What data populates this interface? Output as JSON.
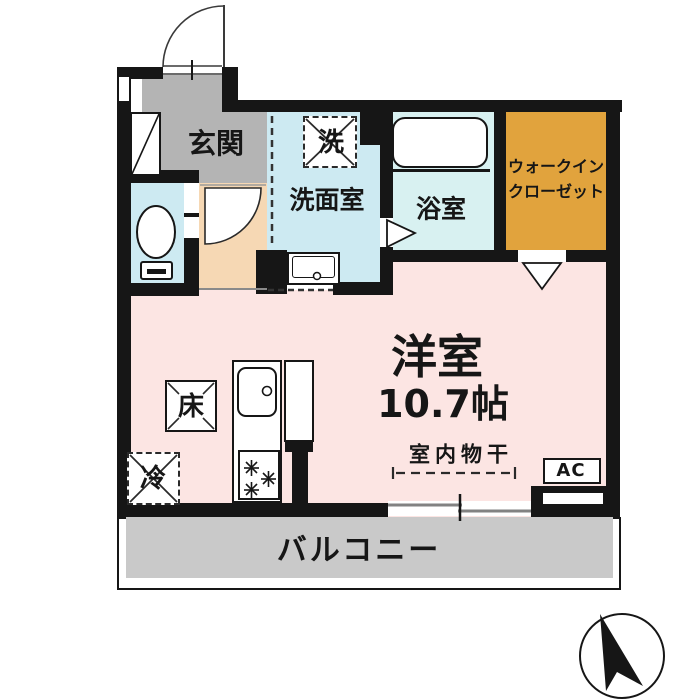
{
  "plan": {
    "rooms": {
      "genkan": "玄関",
      "washroom": "洗面室",
      "washer": "洗",
      "bathroom": "浴室",
      "wic_line1": "ウォークイン",
      "wic_line2": "クローゼット",
      "main_room_name": "洋室",
      "main_room_size": "10.7帖",
      "balcony": "バルコニー"
    },
    "fixtures": {
      "floor_storage": "床",
      "fridge": "冷",
      "ac": "AC",
      "indoor_drying": "室内物干"
    },
    "colors": {
      "wall": "#161616",
      "genkan_gray": "#b4b4b4",
      "water_blue": "#cdeaf2",
      "bath_blue": "#d8f1f1",
      "corridor_peach": "#f6d8b4",
      "main_pink": "#fce5e3",
      "wic_orange": "#e1a33d",
      "balcony_gray": "#c9c9c9"
    }
  }
}
